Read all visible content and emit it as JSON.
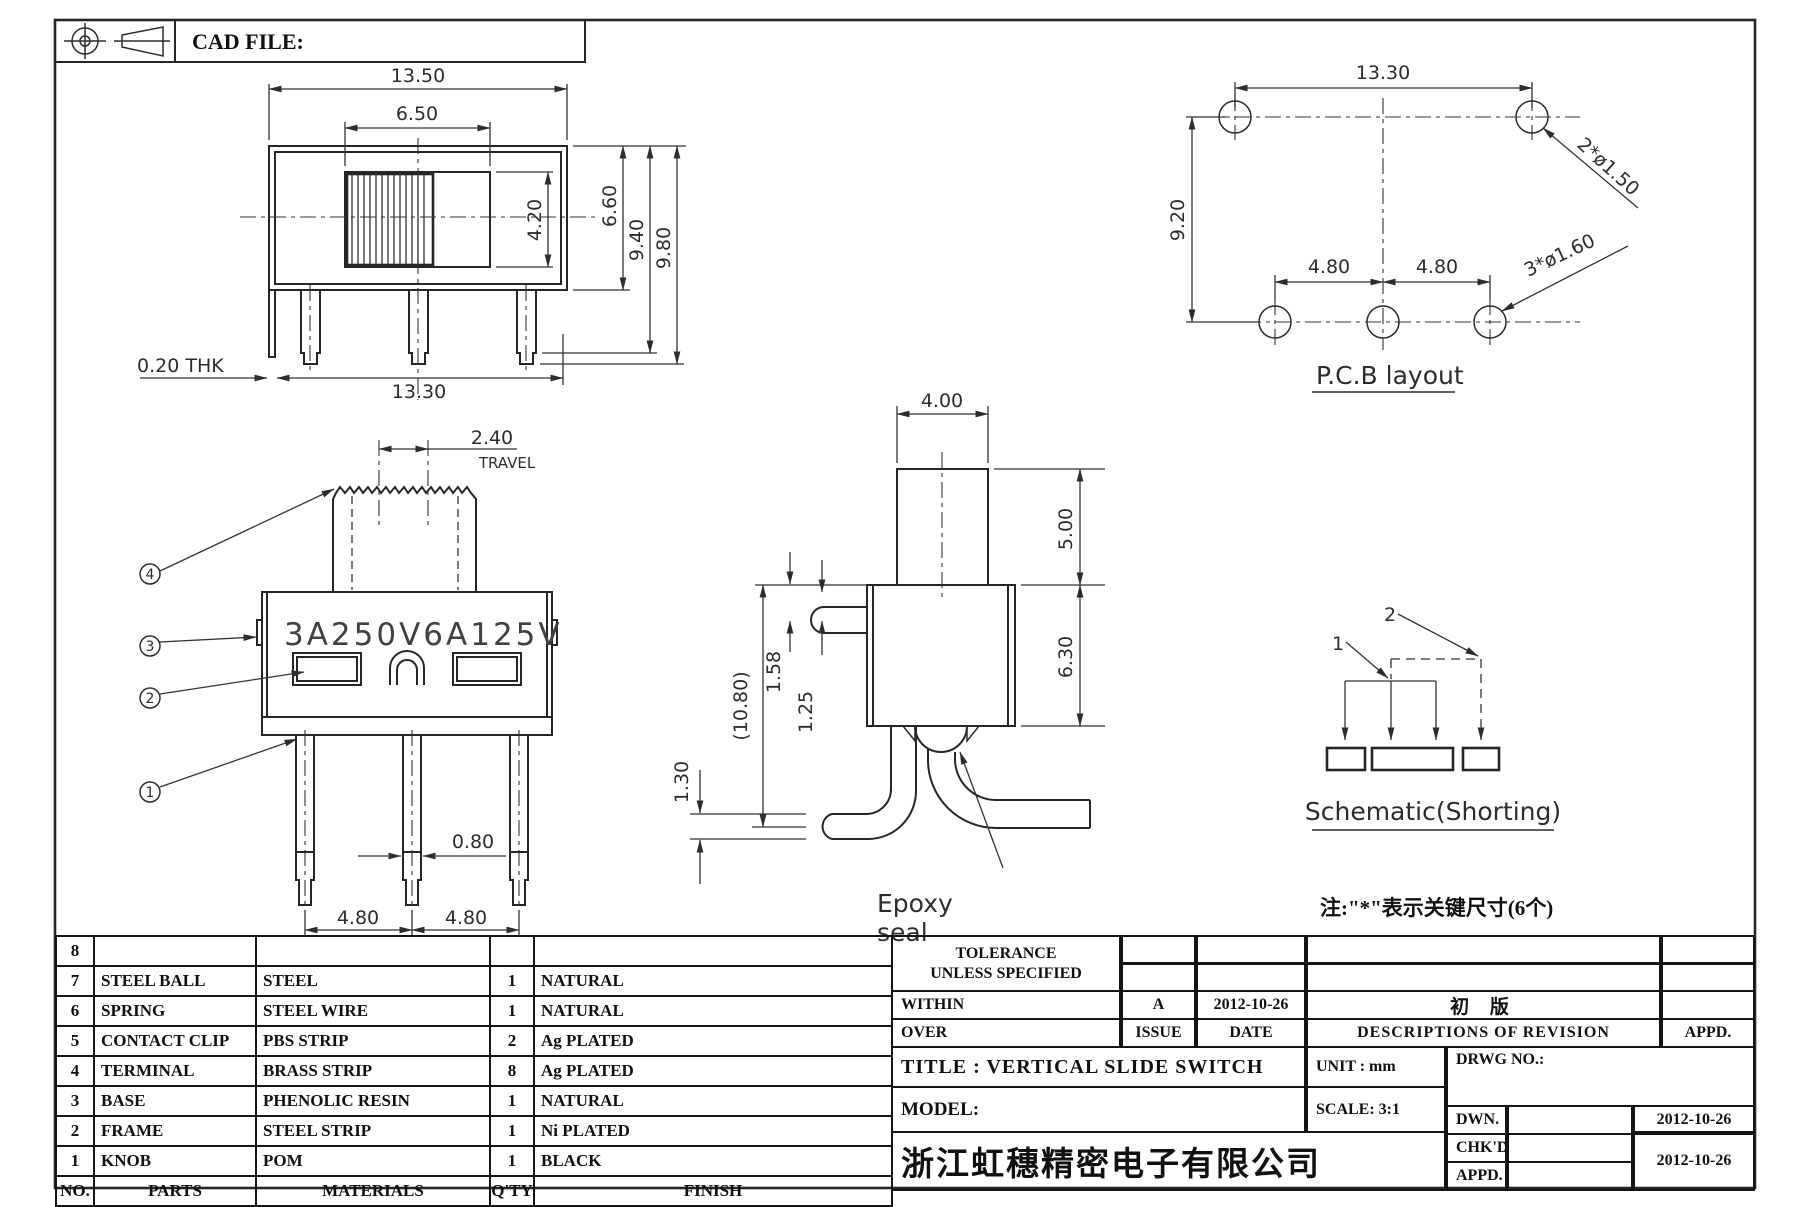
{
  "sheet": {
    "cad_file_label": "CAD FILE:"
  },
  "front_view": {
    "dim_total_w": "13.50",
    "dim_window_w": "6.50",
    "dim_knob_h": "4.20",
    "dim_body_h": "6.60",
    "dim_pin_step_h": "9.40",
    "dim_pin_h": "9.80",
    "dim_thk": "0.20  THK",
    "dim_bottom_w": "13.30"
  },
  "pcb_layout": {
    "title": "P.C.B layout",
    "dim_w": "13.30",
    "dim_h": "9.20",
    "dim_pitch_l": "4.80",
    "dim_pitch_r": "4.80",
    "label_top_holes": "2*ø1.50",
    "label_bottom_holes": "3*ø1.60"
  },
  "marking_view": {
    "dim_travel": "2.40",
    "label_travel": "TRAVEL",
    "marking": "3A250V6A125V",
    "dim_pin_w": "0.80",
    "dim_pitch_l": "4.80",
    "dim_pitch_r": "4.80",
    "callout_1": "1",
    "callout_2": "2",
    "callout_3": "3",
    "callout_4": "4"
  },
  "side_view": {
    "dim_knob_w": "4.00",
    "dim_knob_h": "5.00",
    "dim_body_h": "6.30",
    "dim_pin_off_1": "1.58",
    "dim_pin_off_2": "1.25",
    "dim_total_h": "(10.80)",
    "dim_pin_thk": "1.30",
    "label_epoxy_1": "Epoxy",
    "label_epoxy_2": "seal"
  },
  "schematic": {
    "pin_1": "1",
    "pin_2": "2",
    "title": "Schematic(Shorting)"
  },
  "note": "注:\"*\"表示关键尺寸(6个)",
  "parts_table": {
    "headers": {
      "no": "NO.",
      "parts": "PARTS",
      "materials": "MATERIALS",
      "qty": "Q'TY",
      "finish": "FINISH"
    },
    "rows": [
      {
        "no": "8",
        "part": "",
        "material": "",
        "qty": "",
        "finish": ""
      },
      {
        "no": "7",
        "part": "STEEL BALL",
        "material": "STEEL",
        "qty": "1",
        "finish": "NATURAL"
      },
      {
        "no": "6",
        "part": "SPRING",
        "material": "STEEL WIRE",
        "qty": "1",
        "finish": "NATURAL"
      },
      {
        "no": "5",
        "part": "CONTACT CLIP",
        "material": "PBS STRIP",
        "qty": "2",
        "finish": "Ag PLATED"
      },
      {
        "no": "4",
        "part": "TERMINAL",
        "material": "BRASS STRIP",
        "qty": "8",
        "finish": "Ag PLATED"
      },
      {
        "no": "3",
        "part": "BASE",
        "material": "PHENOLIC RESIN",
        "qty": "1",
        "finish": "NATURAL"
      },
      {
        "no": "2",
        "part": "FRAME",
        "material": "STEEL STRIP",
        "qty": "1",
        "finish": "Ni PLATED"
      },
      {
        "no": "1",
        "part": "KNOB",
        "material": "POM",
        "qty": "1",
        "finish": "BLACK"
      }
    ]
  },
  "title_block": {
    "tolerance_line1": "TOLERANCE",
    "tolerance_line2": "UNLESS  SPECIFIED",
    "within": "WITHIN",
    "over": "OVER",
    "issue_header": "ISSUE",
    "date_header": "DATE",
    "desc_header": "DESCRIPTIONS  OF  REVISION",
    "appd_header": "APPD.",
    "rev_issue": "A",
    "rev_date": "2012-10-26",
    "rev_desc": "初  版",
    "title": "TITLE :   VERTICAL  SLIDE  SWITCH",
    "unit": "UNIT :   mm",
    "drwg_no": "DRWG  NO.:",
    "model": "MODEL:",
    "scale": "SCALE:   3:1",
    "dwn": "DWN.",
    "chkd": "CHK'D",
    "appd": "APPD.",
    "dwn_date": "2012-10-26",
    "chkd_appd_date": "2012-10-26",
    "company": "浙江虹穗精密电子有限公司"
  }
}
